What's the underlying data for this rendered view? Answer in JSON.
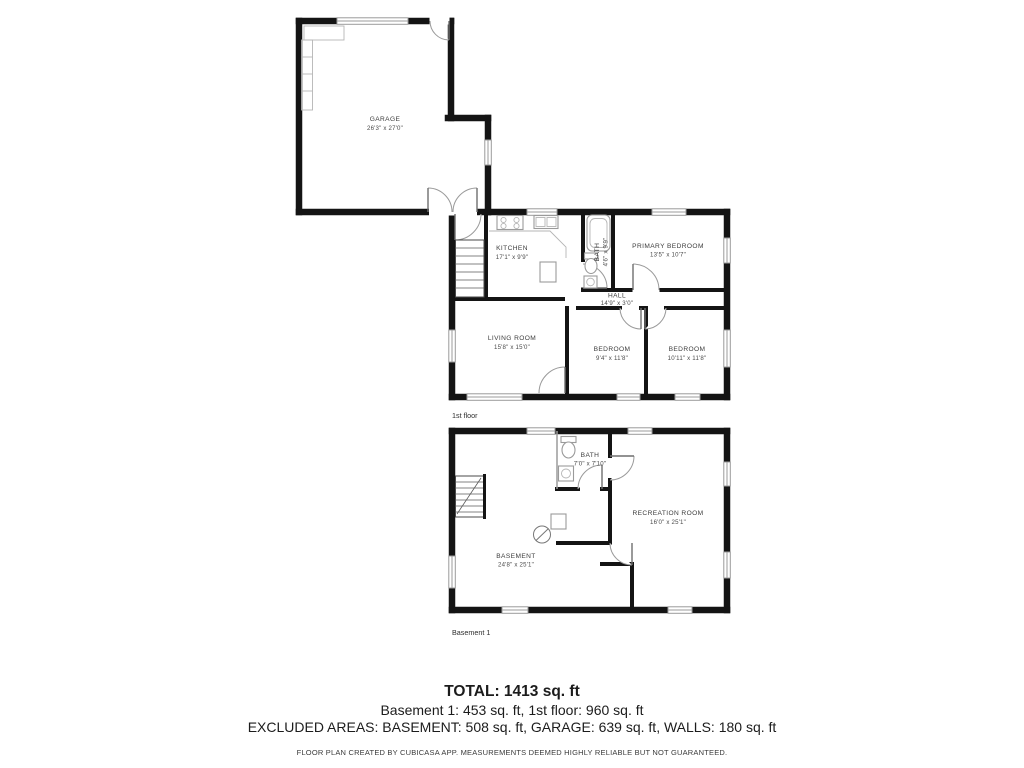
{
  "floors": {
    "first": {
      "label": "1st floor",
      "rooms": {
        "garage": {
          "name": "GARAGE",
          "dims": "26'3\" x 27'0\""
        },
        "kitchen": {
          "name": "KITCHEN",
          "dims": "17'1\" x 9'9\""
        },
        "bath": {
          "name": "BATH",
          "dims": "4'6\" x 9'9\""
        },
        "primary_bedroom": {
          "name": "PRIMARY BEDROOM",
          "dims": "13'5\" x 10'7\""
        },
        "hall": {
          "name": "HALL",
          "dims": "14'9\" x 3'0\""
        },
        "living_room": {
          "name": "LIVING ROOM",
          "dims": "15'8\" x 15'0\""
        },
        "bedroom_left": {
          "name": "BEDROOM",
          "dims": "9'4\" x 11'8\""
        },
        "bedroom_right": {
          "name": "BEDROOM",
          "dims": "10'11\" x 11'8\""
        }
      }
    },
    "basement": {
      "label": "Basement 1",
      "rooms": {
        "bath": {
          "name": "BATH",
          "dims": "7'0\" x 7'10\""
        },
        "recreation_room": {
          "name": "RECREATION ROOM",
          "dims": "16'0\" x 25'1\""
        },
        "basement": {
          "name": "BASEMENT",
          "dims": "24'8\" x 25'1\""
        }
      }
    }
  },
  "summary": {
    "total": "TOTAL: 1413 sq. ft",
    "floors_line": "Basement 1: 453 sq. ft, 1st floor: 960 sq. ft",
    "excluded_line": "EXCLUDED AREAS: BASEMENT: 508 sq. ft, GARAGE: 639 sq. ft, WALLS: 180 sq. ft",
    "disclaimer": "FLOOR PLAN CREATED BY CUBICASA APP. MEASUREMENTS DEEMED HIGHLY RELIABLE BUT NOT GUARANTEED."
  },
  "colors": {
    "wall": "#141414",
    "window": "#9b9b9b",
    "door": "#9a9a9a",
    "label": "#3c3c3c"
  }
}
